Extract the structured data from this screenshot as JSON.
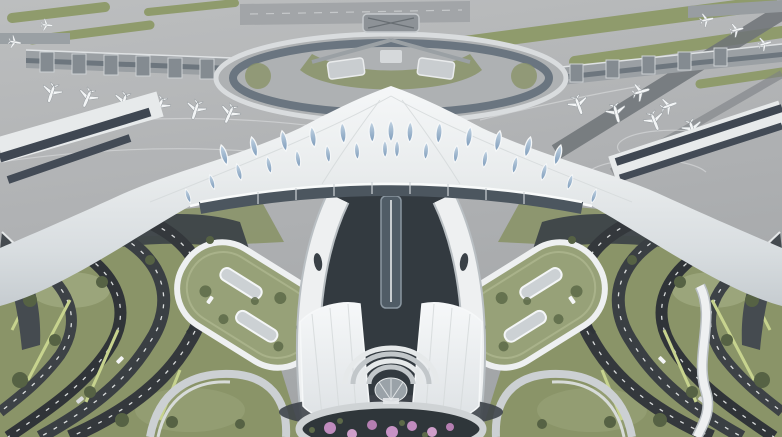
{
  "scene": {
    "type": "architectural-rendering",
    "description": "Aerial rendering of a futuristic airport terminal: a white winged roof with a pointed apex and two rows of diamond-shaped blue skylights, flanked by airside concourses with parked airplanes, a landside oval courtyard behind the apex, dark elevated roadway arcs sweeping around landscaped grounds, two kidney-shaped green-roof buildings, a central entrance pavilion with a fan canopy and glass dome, an oval blossom garden, and multi-lane approach highways in the foreground corners",
    "elements": [
      "terminal-roof",
      "diamond-skylights",
      "airside-concourse-left",
      "airside-concourse-right",
      "parked-airplanes",
      "landside-courtyard",
      "glass-facade-arc",
      "elevated-roadways",
      "green-roof-building-left",
      "green-roof-building-right",
      "entrance-pavilion",
      "fan-canopy",
      "entrance-dome",
      "blossom-garden",
      "approach-highways",
      "pedestrian-ribbon-bridge"
    ]
  },
  "counts": {
    "diamond_skylights": 29,
    "airplanes": 17,
    "green_roof_buildings": 2,
    "roadway_arcs_per_side": 4
  },
  "palette": {
    "tarmac_light": "#b9bbbc",
    "tarmac_mid": "#aaacae",
    "taxiway_dark": "#6f7478",
    "grass_strip": "#8f9b6c",
    "roof_white": "#edeff0",
    "roof_shadow": "#c9cfd3",
    "skylight_blue": "#8fadc9",
    "facade_glass": "#4c565f",
    "road_dark": "#34383c",
    "lane_white": "#e9ebec",
    "greenery": "#8a9468",
    "tree_dark": "#566244",
    "green_roof": "#97a178",
    "accent_lime": "#c7d38e",
    "blossom_pink": "#c08cbe",
    "ribbon_white": "#eef0f1",
    "canyon_dark": "#333a40"
  }
}
